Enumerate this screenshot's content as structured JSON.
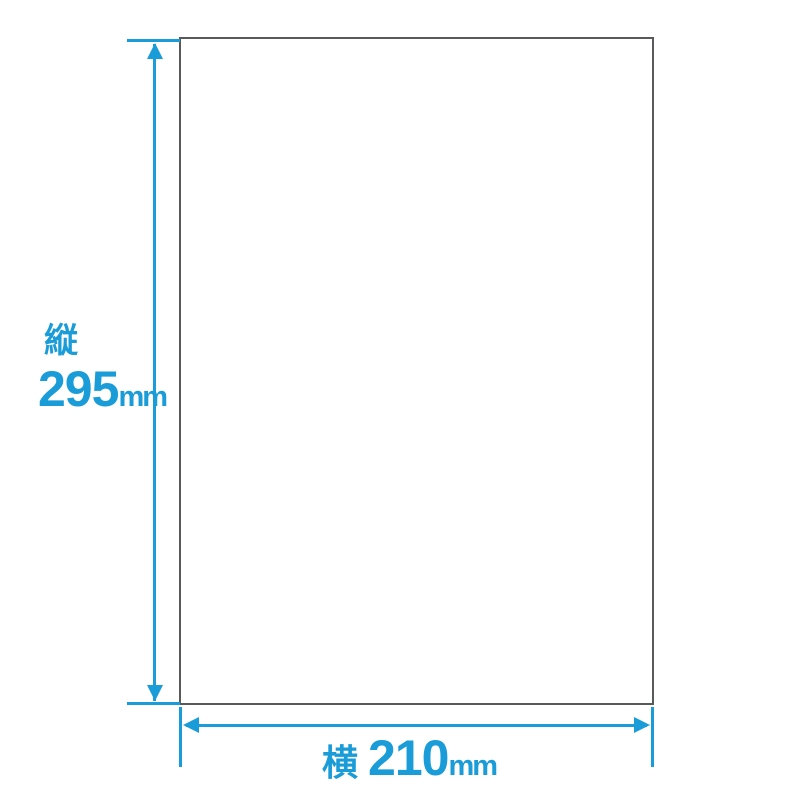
{
  "diagram": {
    "title": "paper-size-dimension-diagram",
    "vertical_dimension": {
      "axis_label": "縦",
      "value": "295",
      "unit": "mm"
    },
    "horizontal_dimension": {
      "axis_label": "横",
      "value": "210",
      "unit": "mm"
    }
  },
  "colors": {
    "accent": "#1a9cd8",
    "paper_border": "#58595b",
    "background": "#ffffff"
  }
}
